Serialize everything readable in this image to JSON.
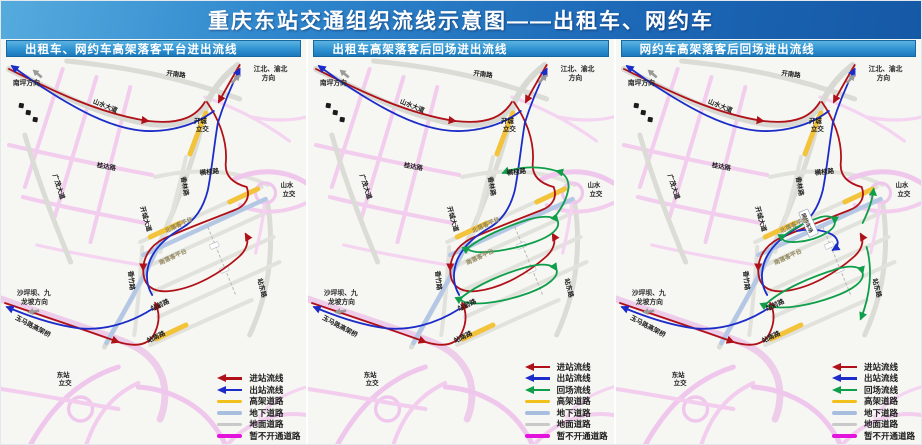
{
  "title": "重庆东站交通组织流线示意图——出租车、网约车",
  "panels": [
    {
      "header": "出租车、网约车高架落客平台进出流线"
    },
    {
      "header": "出租车高架落客后回场进出流线"
    },
    {
      "header": "网约车高架落客后回场进出流线"
    }
  ],
  "legend": {
    "jinzhan": {
      "label": "进站流线",
      "color": "#b01118"
    },
    "chuzhan": {
      "label": "出站流线",
      "color": "#1b2cc8"
    },
    "huichang": {
      "label": "回场流线",
      "color": "#0f9e4a"
    },
    "gaojia": {
      "label": "高架道路",
      "color": "#f2c01d"
    },
    "dixia": {
      "label": "地下道路",
      "color": "#a7bede"
    },
    "dimian": {
      "label": "地面道路",
      "color": "#c9c9c9"
    },
    "zanbu": {
      "label": "暂不开通道路",
      "color": "#e312dd"
    }
  },
  "map_labels": {
    "nanping": "南坪方向",
    "jiangbei_l1": "江北、渝北",
    "jiangbei_l2": "方向",
    "shaping_l1": "沙坪坝、九",
    "shaping_l2": "龙坡方向",
    "kainan_rd": "开南路",
    "shanshui_ave": "山水大道",
    "kaicheng_ic_l1": "开城",
    "kaicheng_ic_l2": "立交",
    "shanshui_ic_l1": "山水",
    "shanshui_ic_l2": "立交",
    "dongzhan_ic_l1": "东站",
    "dongzhan_ic_l2": "立交",
    "guangmao_ave": "广茂大道",
    "guida_rd": "桂达路",
    "kaicheng_ave": "开城大道",
    "xianglin_rd": "香林路",
    "henggui_rd": "横桂路",
    "north_platform": "北落客平台",
    "south_platform": "南落客平台",
    "xiangzhu_rd": "香竹路",
    "zhanqian_rd": "站前路",
    "zhannan_rd": "站南路",
    "zhandong_rd": "站东路",
    "yuma_viaduct": "玉马路高架桥",
    "wangyueche_lot": "网约车场"
  },
  "colors": {
    "title_bar": "#1f78c8",
    "panel_header": "#2f93d2",
    "map_background": "#f6f6f2",
    "closed_road_map": "#f0c7ec",
    "ground_road_map": "#dcdcd7"
  }
}
